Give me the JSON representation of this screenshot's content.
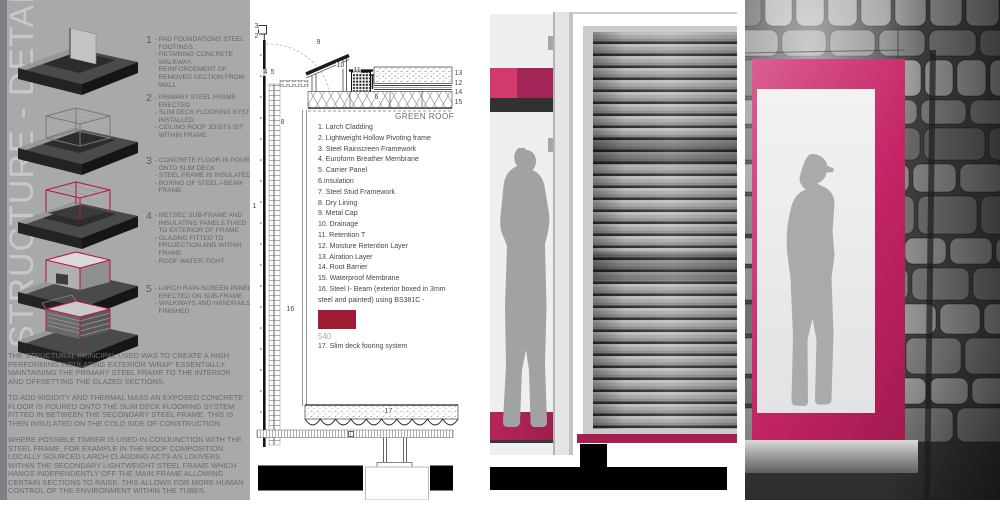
{
  "title": "STRUCTURE - DETAIL",
  "steps": [
    {
      "num": "1",
      "text": "- PAD FOUNDATIONS STEEL\n  FOOTINGS.\n- RETAINING CONCRETE\n  WALKWAY.\n  REINFORCEMENT OF\n  REMOVED SECTION FROM\n  WALL"
    },
    {
      "num": "2",
      "text": "- PRIMARY STEEL FRAME\n  ERECTED\n- SLIM DECK FLOORING SYSTEM\n  INSTALLED\n- CEILING ROOF JOISTS SIT\n  WITHIN FRAME"
    },
    {
      "num": "3",
      "text": "- CONCRETE FLOOR IS POURED\n  ONTO SLIM DECK\n- STEEL FRAME IS INSULATED\n- BOXING OF STEEL I-BEAM\n  FRAME"
    },
    {
      "num": "4",
      "text": "- METSEC SUB-FRAME AND\n  INSULATING PANELS FIXED\n  TO EXTERIOR OF FRAME\n- GLAZING FITTED TO\n  PROJECTION AND WITHIN\n  FRAME\n- ROOF WATER-TIGHT"
    },
    {
      "num": "5",
      "text": "- LARCH RAIN-SCREEN PANELS\n  ERECTED ON SUB-FRAME\n- WALKWAYS AND HANDRAILS\n  FINISHED"
    }
  ],
  "paragraphs": [
    "THE STRUCTURAL PRINCIPAL USED WAS TO CREATE A HIGH PERFORMING INSULATING EXTERIOR 'WRAP' ESSENTIALLY MAINTAINING THE PRIMARY STEEL FRAME TO THE INTERIOR AND OFFSETTING THE GLAZED SECTIONS.",
    "TO ADD RIGIDITY AND THERMAL MASS AN EXPOSED CONCRETE FLOOR IS POURED ONTO THE SLIM DECK FLOORING SYSTEM FITTED IN BETWEEN THE SECONDARY STEEL FRAME. THIS IS THEN INSULATED ON THE COLD SIDE OF CONSTRUCTION.",
    "WHERE POSSIBLE TIMBER IS USED IN CONJUNCTION WITH THE STEEL FRAME, FOR EXAMPLE IN THE ROOF COMPOSITION, LOCALLY SOURCED LARCH CLADDING ACTS AS LOUVERS WITHIN THE SECONDARY LIGHTWEIGHT STEEL FRAME WHICH HANGS INDEPENDENTLY OFF THE MAIN FRAME ALLOWING CERTAIN SECTIONS TO RAISE. THIS ALLOWS FOR MORE HUMAN CONTROL OF THE ENVIRONMENT WITHIN THE TUBES."
  ],
  "legend": {
    "header": "GREEN ROOF",
    "items": [
      "1. Larch Cladding",
      "2. Lightweight Hollow Pivoting frame",
      "3. Steel Rainscreen Framework",
      "4. Euroform Breather Membrane",
      "5. Carrier Panel",
      "6.Insulation",
      "7. Steel Stud Framework",
      "8. Dry Lining",
      "9. Metal Cap",
      "10. Drainage",
      "11. Retention T",
      "12. Moisture Retention Layer",
      "13. Airation Layer",
      "14. Root Barrier",
      "15. Waterproof Membrane",
      "16. Steel I- Beam (exterior boxed in 3mm steel and painted) using BS381C -"
    ],
    "swatch_code": "540",
    "item17": "17. Slim deck fooring system"
  },
  "callouts": [
    "3",
    "2",
    "9",
    "10",
    "11",
    "4",
    "5",
    "13",
    "12",
    "14",
    "15",
    "6",
    "8",
    "1",
    "16",
    "17"
  ],
  "colors": {
    "panel_gray": "#a7a9ab",
    "bright_pink": "#d23a6c",
    "deep_crimson": "#a32457",
    "frame_magenta": "#c42465",
    "swatch_crimson": "#9c1c33",
    "axon_crimson": "#c0134d"
  }
}
